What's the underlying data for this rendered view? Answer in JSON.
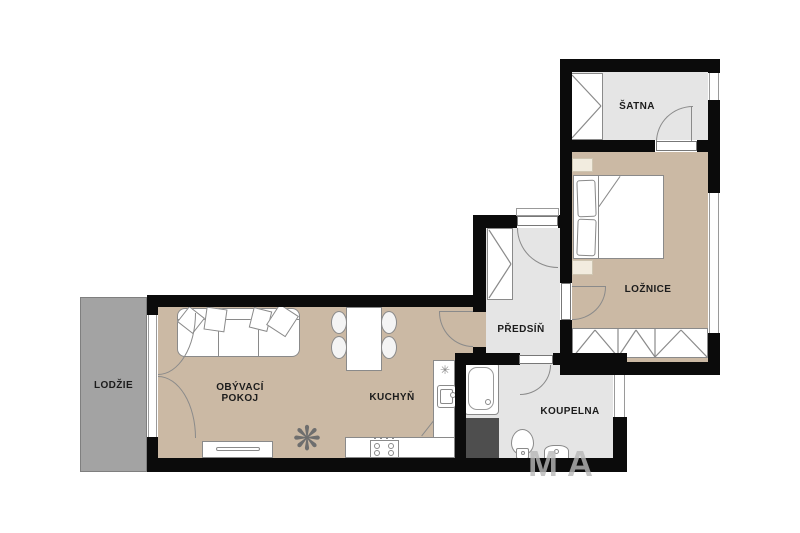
{
  "colors": {
    "wall": "#0b0b0b",
    "floor_beige": "#cbb9a4",
    "floor_gray": "#e5e5e5",
    "loggia_gray": "#a3a3a3",
    "furniture_outline": "#8a8a8a",
    "shaft_dark": "#4e4e4e",
    "label_text": "#1c1c1c",
    "watermark_gray": "#b8b8b8"
  },
  "rooms": {
    "lodzie": {
      "label": "LODŽIE"
    },
    "obyvaci_pokoj": {
      "label_line1": "OBÝVACÍ",
      "label_line2": "POKOJ"
    },
    "kuchyn": {
      "label": "KUCHYŇ"
    },
    "predsin": {
      "label": "PŘEDSÍŇ"
    },
    "koupelna": {
      "label": "KOUPELNA"
    },
    "loznice": {
      "label": "LOŽNICE"
    },
    "satna": {
      "label": "ŠATNA"
    }
  },
  "symbols": {
    "plant": "❋",
    "vent": "✳"
  },
  "watermark": {
    "text": "MA"
  }
}
